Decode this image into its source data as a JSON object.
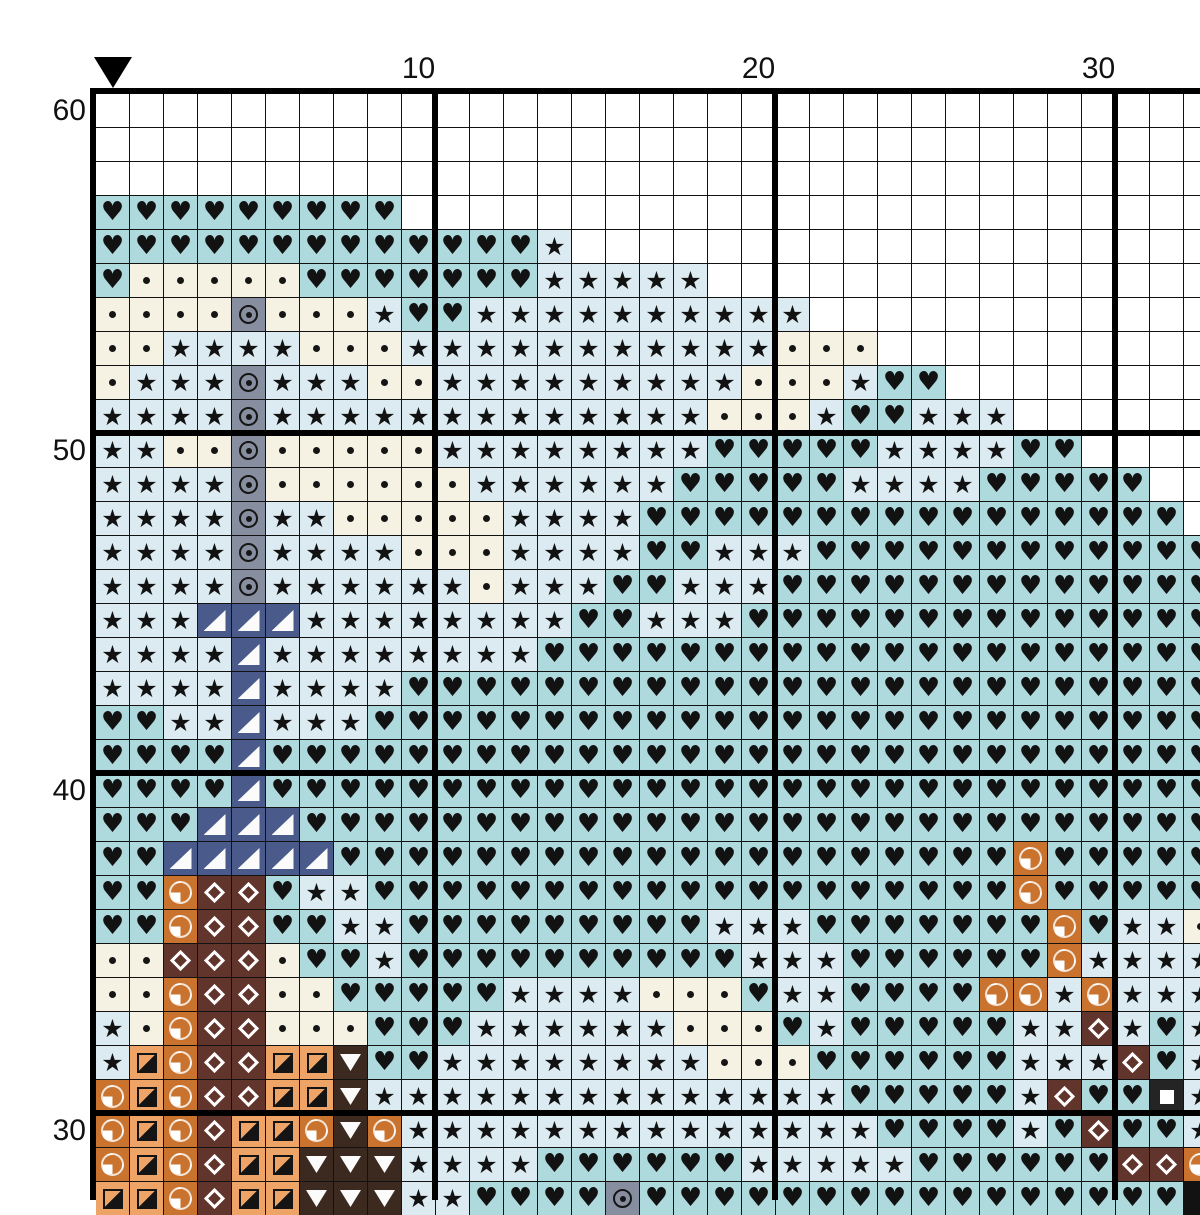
{
  "chart_title": "cross-stitch pattern grid",
  "marker": {
    "name": "start-column-marker",
    "column": 1
  },
  "axis": {
    "col_labels": [
      {
        "text": "10",
        "col": 10
      },
      {
        "text": "20",
        "col": 20
      },
      {
        "text": "30",
        "col": 30
      }
    ],
    "row_labels": [
      {
        "text": "60",
        "row": 60
      },
      {
        "text": "50",
        "row": 50
      },
      {
        "text": "40",
        "row": 40
      },
      {
        "text": "30",
        "row": 30
      }
    ]
  },
  "grid": {
    "first_row_number": 60,
    "visible_columns": 33,
    "visible_rows": 33,
    "cell_codes": {
      "H": {
        "symbol": "heart",
        "bg": "#aedade",
        "fg": "#121212",
        "glyph": "♥"
      },
      "S": {
        "symbol": "star",
        "bg": "#dcebf2",
        "fg": "#121212",
        "glyph": "★"
      },
      "d": {
        "symbol": "dot",
        "bg": "#f6f2e3"
      },
      "O": {
        "symbol": "circled-dot",
        "bg": "#878e9f"
      },
      "N": {
        "symbol": "lower-right-triangle",
        "bg": "#4a5a8b"
      },
      "Q": {
        "symbol": "quarter-circle",
        "bg": "#c9732e"
      },
      "D": {
        "symbol": "diamond-outline",
        "bg": "#61342c"
      },
      "T": {
        "symbol": "half-square-diagonal",
        "bg": "#eda466"
      },
      "V": {
        "symbol": "down-triangle",
        "bg": "#3c2a20"
      },
      "W": {
        "symbol": "white-square",
        "bg": "#242424"
      },
      ".": {
        "symbol": "empty",
        "bg": "#ffffff"
      }
    },
    "rows": [
      {
        "row": 60,
        "cells": "................................."
      },
      {
        "row": 59,
        "cells": "................................."
      },
      {
        "row": 58,
        "cells": "................................."
      },
      {
        "row": 57,
        "cells": "HHHHHHHHH........................"
      },
      {
        "row": 56,
        "cells": "HHHHHHHHHHHHHS..................."
      },
      {
        "row": 55,
        "cells": "HdddddHHHHHHHSSSSS..............."
      },
      {
        "row": 54,
        "cells": "ddddOdddSHHSSSSSSSSSS............"
      },
      {
        "row": 53,
        "cells": "ddSSSSdddSSSSSSSSSSSddd.........."
      },
      {
        "row": 52,
        "cells": "dSSSOSSSddSSSSSSSSSdddSHH........"
      },
      {
        "row": 51,
        "cells": "SSSSOSSSSSSSSSSSSSdddSHHSSS......"
      },
      {
        "row": 50,
        "cells": "SSddOdddddSSSSSSSSHHHHHSSSSHH...."
      },
      {
        "row": 49,
        "cells": "SSSSOddddddSSSSSSHHHHHSSSSHHHHH.."
      },
      {
        "row": 48,
        "cells": "SSSSOSSdddddSSSSHHHHHHHHHHHHHHHH."
      },
      {
        "row": 47,
        "cells": "SSSSOSSSSdddSSSSHHSSSHHHHHHHHHHHH"
      },
      {
        "row": 46,
        "cells": "SSSSOSSSSSSdSSSHHSSSHHHHHHHHHHHHH"
      },
      {
        "row": 45,
        "cells": "SSSNNNSSSSSSSSHHSSSHHHHHHHHHHHHHH"
      },
      {
        "row": 44,
        "cells": "SSSSNSSSSSSSSHHHHHHHHHHHHHHHHHHHH"
      },
      {
        "row": 43,
        "cells": "SSSSNSSSSHHHHHHHHHHHHHHHHHHHHHHHH"
      },
      {
        "row": 42,
        "cells": "HHSSNSSSHHHHHHHHHHHHHHHHHHHHHHHHH"
      },
      {
        "row": 41,
        "cells": "HHHHNHHHHHHHHHHHHHHHHHHHHHHHHHHHH"
      },
      {
        "row": 40,
        "cells": "HHHHNHHHHHHHHHHHHHHHHHHHHHHHHHHHH"
      },
      {
        "row": 39,
        "cells": "HHHNNNHHHHHHHHHHHHHHHHHHHHHHHHHHH"
      },
      {
        "row": 38,
        "cells": "HHNNNNNHHHHHHHHHHHHHHHHHHHHQHHHH"
      },
      {
        "row": 37,
        "cells": "HHHQDDHSSHHHHHHHHHHHHHHHHHHHQHHHH"
      },
      {
        "row": 36,
        "cells": "HHHQDDHHSSHHHHHHHHHSSSHHHHHHHQHSS"
      },
      {
        "row": 35,
        "cells": "dddDDDdHHSHHHHHHHHHHSSSHHHHHHQSSS"
      },
      {
        "row": 34,
        "cells": "SddQDDddHHHHHSSSSdddHSSHHHHQQSQSS"
      },
      {
        "row": 33,
        "cells": "SSdQDDdddHHHSSSSSSdddHSHHHHHSSDSH"
      },
      {
        "row": 32,
        "cells": "SSTQDDTTVHHSSSSSSSSdddHHHHHHSSSDH"
      },
      {
        "row": 31,
        "cells": "SQTQDDTTVSSSSSSSSSSSSSSHHHHHSDHHW"
      },
      {
        "row": 30,
        "cells": "SQTQDTTQVQSSSSSSSSSSSSSSHHHHSHDHH"
      },
      {
        "row": 29,
        "cells": "SQTQDTTVVVSSSSHHHHHHSSSSSHHHHHHDD"
      },
      {
        "row": 28,
        "cells": "QTTQDTTVVVSSHHHHOHHHHHHHHHHHHHHHH"
      }
    ]
  },
  "layout_colors": {
    "gridline": "#121212",
    "heavy_line": "#000000",
    "label": "#111111",
    "background": "#ffffff"
  }
}
